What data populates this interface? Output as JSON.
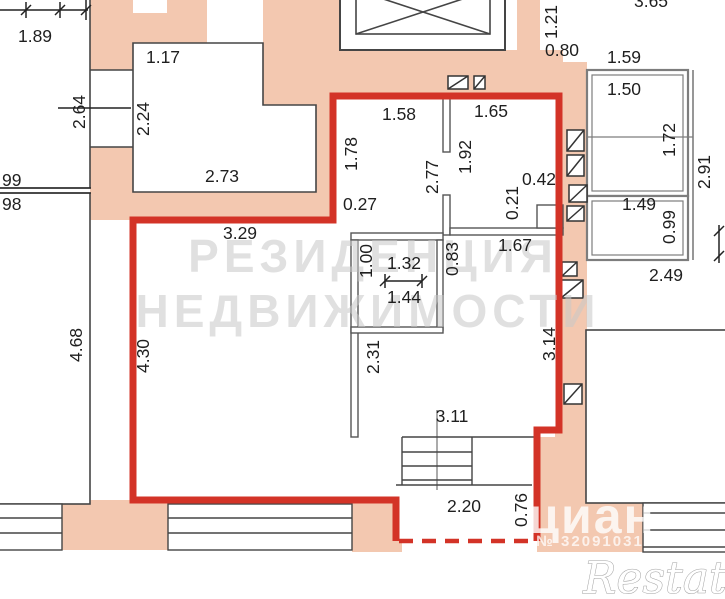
{
  "plan": {
    "watermark_line1": "РЕЗИДЕНЦИЯ",
    "watermark_line2": "НЕДВИЖИМОСТИ",
    "brand_watermark": "циан",
    "brand_listing_id": "№ 32091031",
    "corner_watermark": "Restate"
  },
  "colors": {
    "wall_fill": "#f3c8b0",
    "apartment_outline_red": "#d33327",
    "thin_wall": "#454545",
    "balcony_gray": "#7d7d7d",
    "label_text": "#1f1f1f",
    "watermark_gray": "#c8c8c8"
  },
  "dimension_labels": [
    {
      "text": "1.89",
      "x": 35,
      "y": 36,
      "rotate": 0
    },
    {
      "text": "1.17",
      "x": 163,
      "y": 57,
      "rotate": 0
    },
    {
      "text": "2.73",
      "x": 222,
      "y": 176,
      "rotate": 0
    },
    {
      "text": "1.58",
      "x": 399,
      "y": 114,
      "rotate": 0
    },
    {
      "text": "1.65",
      "x": 491,
      "y": 111,
      "rotate": 0
    },
    {
      "text": "0.27",
      "x": 360,
      "y": 204,
      "rotate": 0,
      "size": 16
    },
    {
      "text": "3.29",
      "x": 240,
      "y": 233,
      "rotate": 0
    },
    {
      "text": "1.32",
      "x": 404,
      "y": 263,
      "rotate": 0
    },
    {
      "text": "1.44",
      "x": 404,
      "y": 297,
      "rotate": 0
    },
    {
      "text": "1.67",
      "x": 515,
      "y": 245,
      "rotate": 0
    },
    {
      "text": "0.42",
      "x": 539,
      "y": 179,
      "rotate": 0
    },
    {
      "text": "1.59",
      "x": 624,
      "y": 57,
      "rotate": 0
    },
    {
      "text": "1.50",
      "x": 624,
      "y": 89,
      "rotate": 0
    },
    {
      "text": "1.49",
      "x": 639,
      "y": 204,
      "rotate": 0
    },
    {
      "text": "2.49",
      "x": 666,
      "y": 275,
      "rotate": 0
    },
    {
      "text": "0.80",
      "x": 562,
      "y": 50,
      "rotate": 0
    },
    {
      "text": "3.11",
      "x": 452,
      "y": 416,
      "rotate": 0
    },
    {
      "text": "2.20",
      "x": 464,
      "y": 506,
      "rotate": 0
    },
    {
      "text": "3.65",
      "x": 651,
      "y": 1,
      "rotate": 0
    },
    {
      "text": "99",
      "x": 2,
      "y": 180,
      "rotate": 0,
      "anchor": "start"
    },
    {
      "text": "98",
      "x": 2,
      "y": 204,
      "rotate": 0,
      "anchor": "start"
    },
    {
      "text": "2.64",
      "x": 79,
      "y": 112,
      "rotate": -90
    },
    {
      "text": "2.24",
      "x": 143,
      "y": 119,
      "rotate": -90
    },
    {
      "text": "1.78",
      "x": 351,
      "y": 154,
      "rotate": -90
    },
    {
      "text": "1.92",
      "x": 465,
      "y": 157,
      "rotate": -90
    },
    {
      "text": "2.77",
      "x": 432,
      "y": 177,
      "rotate": -90
    },
    {
      "text": "0.21",
      "x": 512,
      "y": 203,
      "rotate": -90
    },
    {
      "text": "1.00",
      "x": 366,
      "y": 261,
      "rotate": -90
    },
    {
      "text": "0.83",
      "x": 452,
      "y": 259,
      "rotate": -90
    },
    {
      "text": "1.72",
      "x": 669,
      "y": 140,
      "rotate": -90
    },
    {
      "text": "2.91",
      "x": 704,
      "y": 172,
      "rotate": -90
    },
    {
      "text": "0.99",
      "x": 669,
      "y": 227,
      "rotate": -90
    },
    {
      "text": "1.21",
      "x": 551,
      "y": 22,
      "rotate": -90
    },
    {
      "text": "4.68",
      "x": 76,
      "y": 345,
      "rotate": -90
    },
    {
      "text": "4.30",
      "x": 143,
      "y": 356,
      "rotate": -90
    },
    {
      "text": "2.31",
      "x": 373,
      "y": 357,
      "rotate": -90
    },
    {
      "text": "3.14",
      "x": 549,
      "y": 344,
      "rotate": -90
    },
    {
      "text": "0.76",
      "x": 521,
      "y": 510,
      "rotate": -90
    }
  ]
}
